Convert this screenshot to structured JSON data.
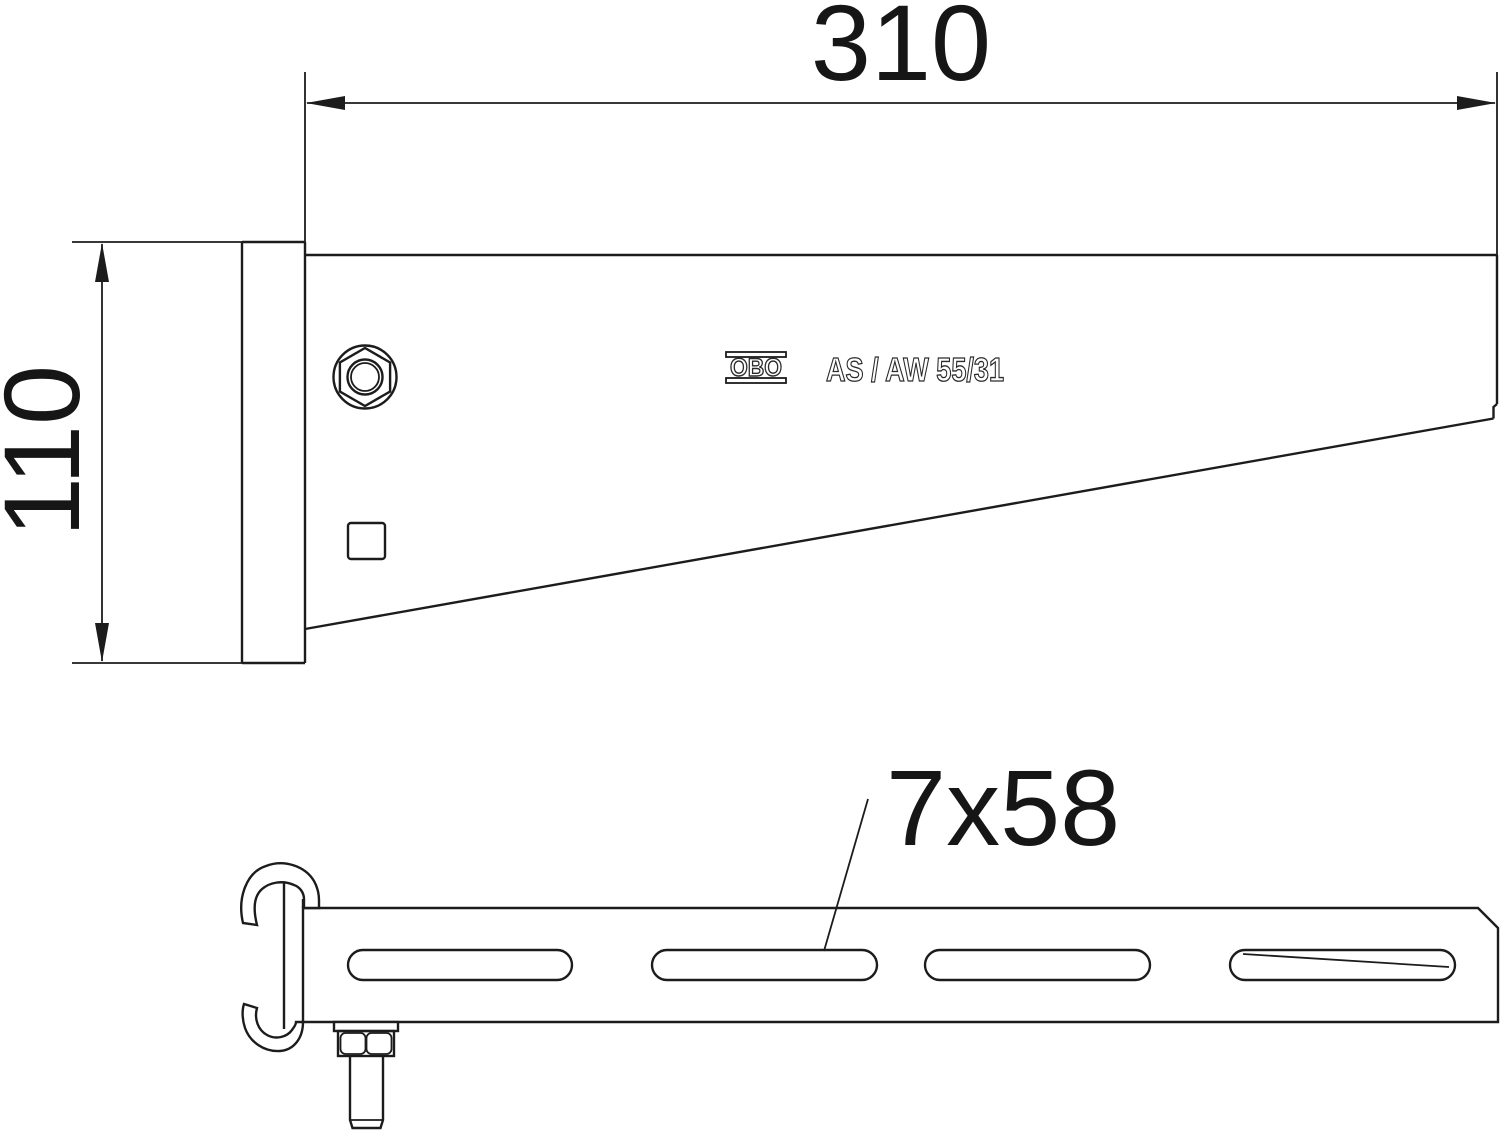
{
  "drawing": {
    "labels": {
      "width_dim": "310",
      "height_dim": "110",
      "slot_dim": "7x58",
      "brand": "OBO",
      "product": "AS / AW 55/31"
    },
    "colors": {
      "line": "#1c1c1c",
      "background": "#ffffff",
      "text": "#161616"
    }
  }
}
